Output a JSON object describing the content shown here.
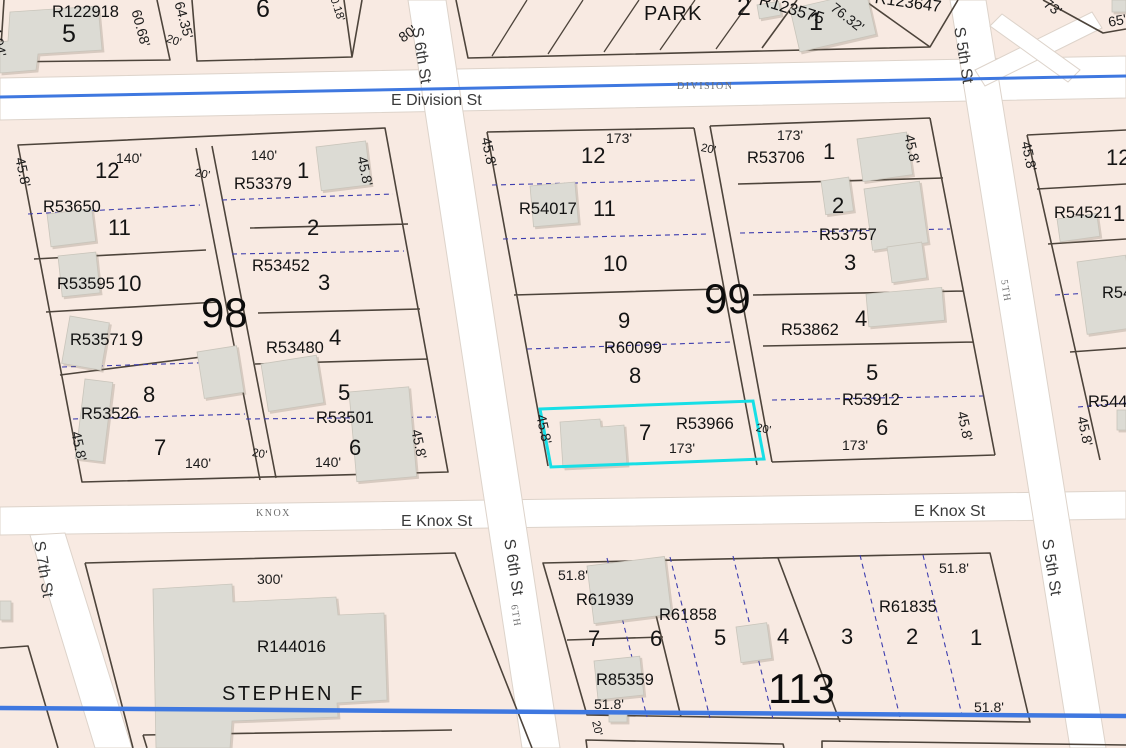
{
  "colors": {
    "background": "#f8eae2",
    "road": "#ffffff",
    "parcel_line": "#4d443b",
    "lot_line": "#3d3dae",
    "centerline": "#3f78e0",
    "building": "#dcdbd4",
    "highlight": "#17dfe6"
  },
  "selection": {
    "parcel_id": "R53966",
    "lot": "7"
  },
  "labels": {
    "streets": [
      {
        "t": "E Division St",
        "x": 391,
        "y": 93,
        "n": "street-label-e-division-st"
      },
      {
        "t": "E Knox St",
        "x": 401,
        "y": 514,
        "n": "street-label-e-knox-st-west"
      },
      {
        "t": "E Knox St",
        "x": 914,
        "y": 504,
        "n": "street-label-e-knox-st-east"
      },
      {
        "t": "S 6th St",
        "x": 424,
        "y": 26,
        "r": 81,
        "n": "street-label-s-6th-st-north"
      },
      {
        "t": "S 6th St",
        "x": 516,
        "y": 538,
        "r": 81,
        "n": "street-label-s-6th-st-south"
      },
      {
        "t": "S 7th St",
        "x": 46,
        "y": 540,
        "r": 81,
        "n": "street-label-s-7th-st"
      },
      {
        "t": "S 5th St",
        "x": 966,
        "y": 26,
        "r": 81,
        "n": "street-label-s-5th-st-north"
      },
      {
        "t": "S 5th St",
        "x": 1054,
        "y": 538,
        "r": 81,
        "n": "street-label-s-5th-st-south"
      }
    ],
    "street_minor": [
      {
        "t": "DIVISION",
        "x": 677,
        "y": 82
      },
      {
        "t": "KNOX",
        "x": 256,
        "y": 509
      },
      {
        "t": "6TH",
        "x": 518,
        "y": 604,
        "r": 81
      },
      {
        "t": "5TH",
        "x": 1008,
        "y": 279,
        "r": 81
      }
    ],
    "blocks": [
      {
        "t": "98",
        "x": 201,
        "y": 292
      },
      {
        "t": "99",
        "x": 704,
        "y": 278
      },
      {
        "t": "113",
        "x": 768,
        "y": 668
      }
    ],
    "places": [
      {
        "t": "PARK",
        "x": 644,
        "y": 4,
        "s": 20,
        "ls": 1.5
      },
      {
        "t": "STEPHEN  F",
        "x": 222,
        "y": 684,
        "s": 20,
        "ls": 2.5
      }
    ],
    "parcel_ids": [
      {
        "t": "R122918",
        "x": 52,
        "y": 4
      },
      {
        "t": "R123575",
        "x": 762,
        "y": -8,
        "r": 17
      },
      {
        "t": "R123647",
        "x": 876,
        "y": -10,
        "r": 8
      },
      {
        "t": "R53650",
        "x": 43,
        "y": 199
      },
      {
        "t": "R53595",
        "x": 57,
        "y": 276
      },
      {
        "t": "R53571",
        "x": 70,
        "y": 332
      },
      {
        "t": "R53526",
        "x": 81,
        "y": 406
      },
      {
        "t": "R53379",
        "x": 234,
        "y": 176
      },
      {
        "t": "R53452",
        "x": 252,
        "y": 258
      },
      {
        "t": "R53480",
        "x": 266,
        "y": 340
      },
      {
        "t": "R53501",
        "x": 316,
        "y": 410
      },
      {
        "t": "R54017",
        "x": 519,
        "y": 201
      },
      {
        "t": "R60099",
        "x": 604,
        "y": 340
      },
      {
        "t": "R53966",
        "x": 676,
        "y": 416
      },
      {
        "t": "R53706",
        "x": 747,
        "y": 150
      },
      {
        "t": "R53757",
        "x": 819,
        "y": 227
      },
      {
        "t": "R53862",
        "x": 781,
        "y": 322
      },
      {
        "t": "R53912",
        "x": 842,
        "y": 392
      },
      {
        "t": "R54521",
        "x": 1054,
        "y": 205
      },
      {
        "t": "R54",
        "x": 1102,
        "y": 285
      },
      {
        "t": "R544",
        "x": 1088,
        "y": 394
      },
      {
        "t": "R144016",
        "x": 257,
        "y": 638,
        "s": 17
      },
      {
        "t": "R61939",
        "x": 576,
        "y": 592
      },
      {
        "t": "R61858",
        "x": 659,
        "y": 607
      },
      {
        "t": "R61835",
        "x": 879,
        "y": 599
      },
      {
        "t": "R85359",
        "x": 596,
        "y": 672
      }
    ],
    "lot_numbers": [
      {
        "t": "5",
        "x": 62,
        "y": 22,
        "s": 25
      },
      {
        "t": "6",
        "x": 256,
        "y": -3,
        "s": 25
      },
      {
        "t": "2",
        "x": 737,
        "y": -5,
        "s": 25
      },
      {
        "t": "1",
        "x": 809,
        "y": 10,
        "s": 25
      },
      {
        "t": "12",
        "x": 95,
        "y": 160
      },
      {
        "t": "11",
        "x": 108,
        "y": 217
      },
      {
        "t": "10",
        "x": 117,
        "y": 273
      },
      {
        "t": "9",
        "x": 131,
        "y": 328
      },
      {
        "t": "8",
        "x": 143,
        "y": 384
      },
      {
        "t": "7",
        "x": 154,
        "y": 437
      },
      {
        "t": "1",
        "x": 297,
        "y": 160
      },
      {
        "t": "2",
        "x": 307,
        "y": 217
      },
      {
        "t": "3",
        "x": 318,
        "y": 272
      },
      {
        "t": "4",
        "x": 329,
        "y": 327
      },
      {
        "t": "5",
        "x": 338,
        "y": 382
      },
      {
        "t": "6",
        "x": 349,
        "y": 437
      },
      {
        "t": "12",
        "x": 581,
        "y": 145
      },
      {
        "t": "11",
        "x": 593,
        "y": 198
      },
      {
        "t": "10",
        "x": 603,
        "y": 253
      },
      {
        "t": "9",
        "x": 618,
        "y": 310
      },
      {
        "t": "8",
        "x": 629,
        "y": 365
      },
      {
        "t": "7",
        "x": 639,
        "y": 422
      },
      {
        "t": "1",
        "x": 823,
        "y": 141
      },
      {
        "t": "2",
        "x": 832,
        "y": 195
      },
      {
        "t": "3",
        "x": 844,
        "y": 252
      },
      {
        "t": "4",
        "x": 855,
        "y": 308
      },
      {
        "t": "5",
        "x": 866,
        "y": 362
      },
      {
        "t": "6",
        "x": 876,
        "y": 417
      },
      {
        "t": "12",
        "x": 1106,
        "y": 147
      },
      {
        "t": "1",
        "x": 1113,
        "y": 203
      },
      {
        "t": "7",
        "x": 588,
        "y": 628
      },
      {
        "t": "6",
        "x": 650,
        "y": 628
      },
      {
        "t": "5",
        "x": 714,
        "y": 627
      },
      {
        "t": "4",
        "x": 777,
        "y": 626
      },
      {
        "t": "3",
        "x": 841,
        "y": 626
      },
      {
        "t": "2",
        "x": 906,
        "y": 626
      },
      {
        "t": "1",
        "x": 970,
        "y": 627
      }
    ],
    "dimensions": [
      {
        "t": "34.94'",
        "x": 1,
        "y": 18,
        "r": 78
      },
      {
        "t": "60.68'",
        "x": 143,
        "y": 8,
        "r": 75
      },
      {
        "t": "20'",
        "x": 168,
        "y": 34,
        "r": 18,
        "s": 11.5
      },
      {
        "t": "64.35'",
        "x": 186,
        "y": 0,
        "r": 75
      },
      {
        "t": "0.18'",
        "x": 338,
        "y": -4,
        "r": 72,
        "s": 11.5
      },
      {
        "t": "80'",
        "x": 396,
        "y": 33,
        "r": -35
      },
      {
        "t": "76.32'",
        "x": 837,
        "y": 0,
        "r": 38
      },
      {
        "t": "73'",
        "x": 1050,
        "y": -4,
        "r": 38
      },
      {
        "t": "65'",
        "x": 1107,
        "y": 15,
        "r": -10
      },
      {
        "t": "45.8'",
        "x": 27,
        "y": 156,
        "r": 78
      },
      {
        "t": "140'",
        "x": 116,
        "y": 151
      },
      {
        "t": "20'",
        "x": 196,
        "y": 168,
        "r": 12,
        "s": 11.5
      },
      {
        "t": "140'",
        "x": 251,
        "y": 148
      },
      {
        "t": "45.8'",
        "x": 369,
        "y": 155,
        "r": 78
      },
      {
        "t": "45.8'",
        "x": 83,
        "y": 430,
        "r": 78
      },
      {
        "t": "140'",
        "x": 185,
        "y": 456
      },
      {
        "t": "20'",
        "x": 253,
        "y": 448,
        "r": 10,
        "s": 11.5
      },
      {
        "t": "140'",
        "x": 315,
        "y": 455
      },
      {
        "t": "45.8'",
        "x": 423,
        "y": 428,
        "r": 78
      },
      {
        "t": "45.8'",
        "x": 493,
        "y": 136,
        "r": 78
      },
      {
        "t": "173'",
        "x": 606,
        "y": 131
      },
      {
        "t": "20'",
        "x": 702,
        "y": 143,
        "r": 12,
        "s": 11.5
      },
      {
        "t": "45.8'",
        "x": 548,
        "y": 413,
        "r": 78
      },
      {
        "t": "173'",
        "x": 669,
        "y": 441
      },
      {
        "t": "20'",
        "x": 757,
        "y": 423,
        "r": 12,
        "s": 11.5
      },
      {
        "t": "173'",
        "x": 777,
        "y": 128
      },
      {
        "t": "45.8'",
        "x": 916,
        "y": 133,
        "r": 78
      },
      {
        "t": "173'",
        "x": 842,
        "y": 438
      },
      {
        "t": "45.8'",
        "x": 969,
        "y": 410,
        "r": 78
      },
      {
        "t": "45.8'",
        "x": 1033,
        "y": 140,
        "r": 78
      },
      {
        "t": "45.8'",
        "x": 1089,
        "y": 415,
        "r": 78
      },
      {
        "t": "300'",
        "x": 257,
        "y": 572
      },
      {
        "t": "51.8'",
        "x": 558,
        "y": 568
      },
      {
        "t": "51.8'",
        "x": 939,
        "y": 561
      },
      {
        "t": "51.8'",
        "x": 594,
        "y": 697
      },
      {
        "t": "20'",
        "x": 600,
        "y": 720,
        "r": 78,
        "s": 11.5
      },
      {
        "t": "51.8'",
        "x": 974,
        "y": 700
      },
      {
        "t": "45.8'",
        "x": -6,
        "y": 687,
        "r": 78
      }
    ]
  }
}
